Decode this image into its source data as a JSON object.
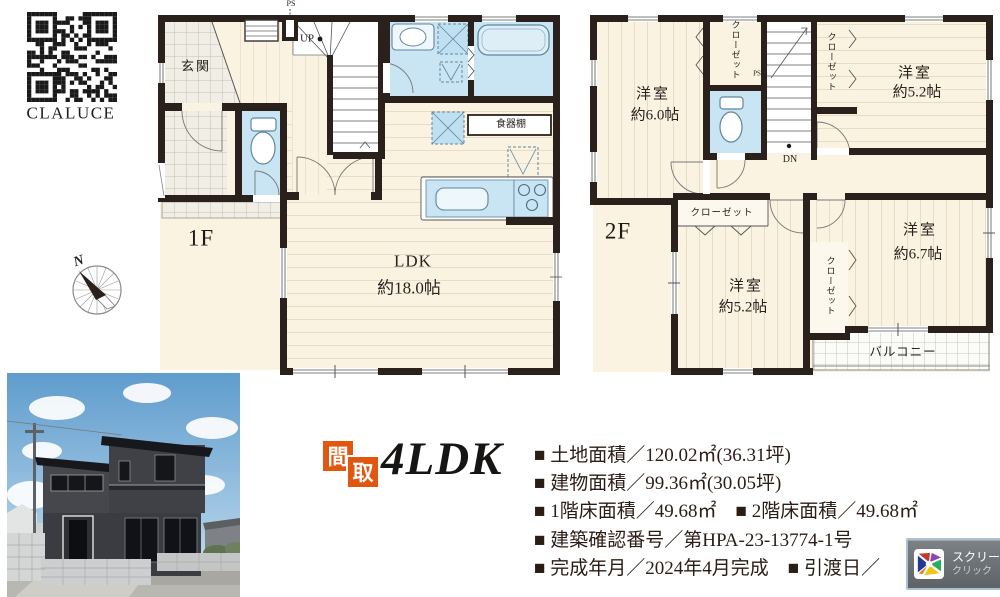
{
  "qr": {
    "caption": "CLALUCE"
  },
  "floor1": {
    "label": "1F",
    "entrance": "玄関",
    "up": "UP",
    "ps": "PS",
    "cupboard": "食器棚",
    "ldk_name": "LDK",
    "ldk_size": "約18.0帖"
  },
  "floor2": {
    "label": "2F",
    "dn": "DN",
    "ps": "PS",
    "closet_label": "クローゼット",
    "balcony": "バルコニー",
    "room_nw": {
      "name": "洋室",
      "size": "約6.0帖"
    },
    "room_ne": {
      "name": "洋室",
      "size": "約5.2帖"
    },
    "room_sw": {
      "name": "洋室",
      "size": "約5.2帖"
    },
    "room_se": {
      "name": "洋室",
      "size": "約6.7帖"
    }
  },
  "compass": {
    "north": "N"
  },
  "badge": {
    "kanji_1": "間",
    "kanji_2": "取",
    "plan_type": "4LDK"
  },
  "details": {
    "line1": "■ 土地面積／120.02㎡(36.31坪)",
    "line2": "■ 建物面積／99.36㎡(30.05坪)",
    "line3": "■ 1階床面積／49.68㎡　■ 2階床面積／49.68㎡",
    "line4": "■ 建築確認番号／第HPA-23-13774-1号",
    "line5": "■ 完成年月／2024年4月完成　■ 引渡日／"
  },
  "toast": {
    "line1": "スクリー",
    "line2": "クリック"
  },
  "colors": {
    "wall": "#2b211c",
    "floor": "#faf3e1",
    "water": "#c9e4f2",
    "accent_orange": "#e2570f"
  }
}
